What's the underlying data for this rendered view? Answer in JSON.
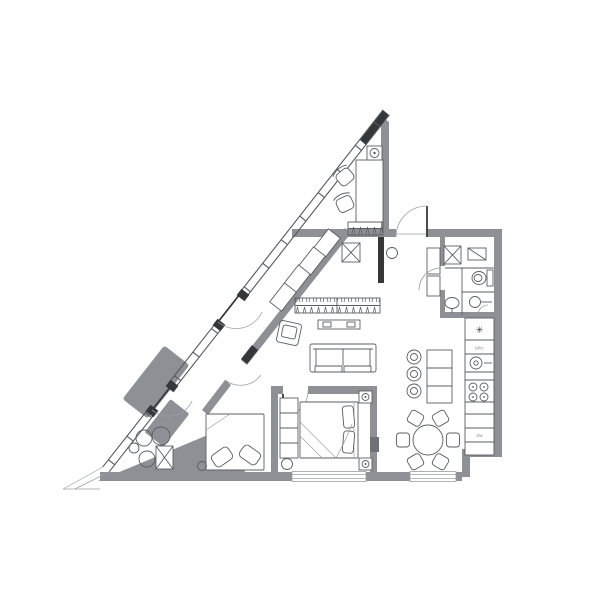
{
  "meta": {
    "type": "architectural floor plan",
    "style": "black-and-white line drawing of a triangular apartment with glazed diagonal facade"
  },
  "colors": {
    "background": "#ffffff",
    "wall": "#8d9196",
    "wall_dark": "#35383b",
    "line": "#55585c",
    "line_light": "#9aa0a5",
    "furniture": "#5a5e62"
  },
  "labels": {
    "fridge_symbol": "✳",
    "oven_label": "bltn",
    "dishwasher_label": "dw"
  },
  "glass_wall": {
    "origin": [
      383,
      110
    ],
    "dir": [
      -0.617,
      0.786
    ],
    "perp": [
      0.786,
      0.617
    ],
    "width": 8,
    "tick_step": 30,
    "draw_segments": [
      [
        0,
        231
      ],
      [
        270,
        347
      ],
      [
        379,
        454
      ]
    ],
    "tick_ranges": [
      [
        15,
        225
      ],
      [
        278,
        340
      ],
      [
        385,
        450
      ]
    ]
  },
  "rooms": [
    {
      "name": "study",
      "furniture": [
        "desk",
        "office-chair",
        "office-chair",
        "ceiling-light",
        "wardrobe"
      ]
    },
    {
      "name": "entry-hall",
      "furniture": [
        "entrance-door",
        "cabinet",
        "pouf",
        "shaft-box"
      ]
    },
    {
      "name": "bathroom",
      "furniture": [
        "washing-machine",
        "boiler",
        "toilet",
        "sink"
      ]
    },
    {
      "name": "wc",
      "furniture": [
        "sink"
      ]
    },
    {
      "name": "corridor",
      "furniture": [
        "sideboard",
        "sideboard",
        "sideboard",
        "sideboard",
        "wardrobe",
        "armchair"
      ]
    },
    {
      "name": "living-room",
      "furniture": [
        "tv-bench",
        "sofa"
      ]
    },
    {
      "name": "kitchen-dining",
      "furniture": [
        "counter",
        "fridge",
        "oven",
        "sink",
        "hob",
        "dishwasher",
        "island",
        "bar-stool",
        "bar-stool",
        "bar-stool",
        "dining-table",
        "chair",
        "chair",
        "chair",
        "chair",
        "chair",
        "chair"
      ]
    },
    {
      "name": "master-bedroom",
      "furniture": [
        "double-bed",
        "nightstand",
        "nightstand",
        "wardrobe",
        "tv-panel",
        "pouf",
        "window"
      ]
    },
    {
      "name": "second-bedroom",
      "furniture": [
        "bed",
        "pillow",
        "pillow",
        "side-table",
        "shaft-box"
      ]
    },
    {
      "name": "terrace",
      "furniture": [
        "round-pot",
        "round-pot",
        "round-pot",
        "round-pot"
      ]
    }
  ]
}
